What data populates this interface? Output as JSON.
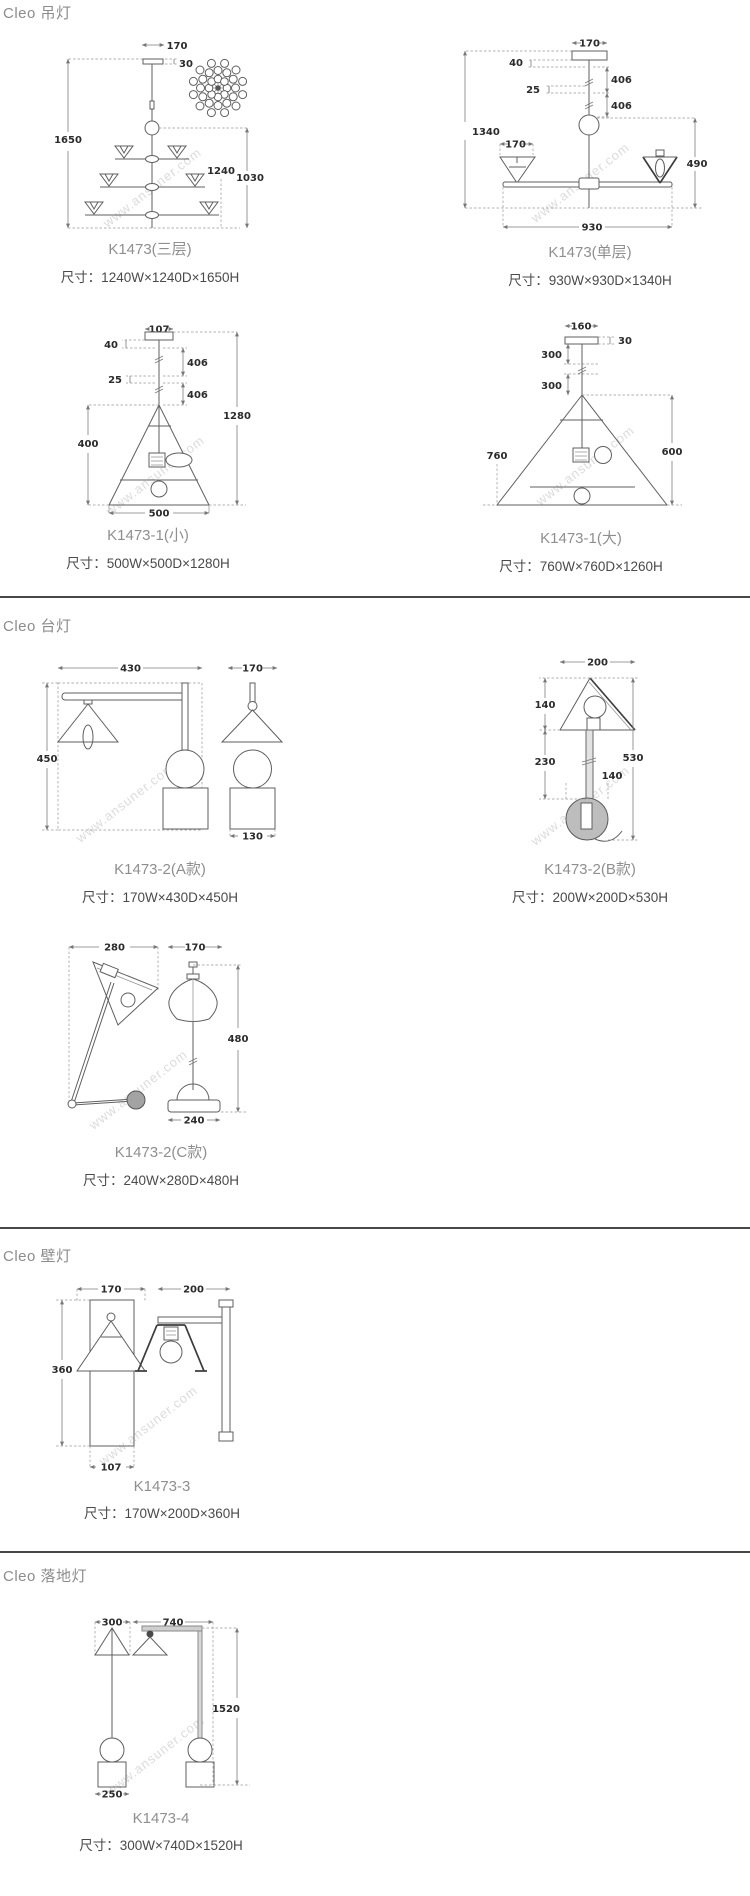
{
  "page": {
    "watermark": "www.ansuner.com"
  },
  "sections": [
    {
      "header": "Cleo 吊灯",
      "products": [
        {
          "name": "K1473(三层)",
          "spec": "尺寸：1240W×1240D×1650H",
          "dims": {
            "top_w": "170",
            "canopy_h": "30",
            "total_h": "1650",
            "width": "1240",
            "body_h": "1030"
          }
        },
        {
          "name": "K1473(单层)",
          "spec": "尺寸：930W×930D×1340H",
          "dims": {
            "top_w": "170",
            "seg_40": "40",
            "rod_a": "406",
            "seg_25": "25",
            "rod_b": "406",
            "total_h": "1340",
            "shade_w": "170",
            "drop_h": "490",
            "width": "930"
          }
        },
        {
          "name": "K1473-1(小)",
          "spec": "尺寸：500W×500D×1280H",
          "dims": {
            "top_w": "107",
            "seg_40": "40",
            "rod_a": "406",
            "seg_25": "25",
            "rod_b": "406",
            "total_h": "1280",
            "shade_h": "400",
            "width": "500"
          }
        },
        {
          "name": "K1473-1(大)",
          "spec": "尺寸：760W×760D×1260H",
          "dims": {
            "top_w": "160",
            "canopy_h": "30",
            "rod_a": "300",
            "rod_b": "300",
            "width": "760",
            "shade_h": "600"
          }
        }
      ]
    },
    {
      "header": "Cleo 台灯",
      "products": [
        {
          "name": "K1473-2(A款)",
          "spec": "尺寸：170W×430D×450H",
          "dims": {
            "depth": "430",
            "shade_w": "170",
            "height": "450",
            "base_w": "130"
          }
        },
        {
          "name": "K1473-2(B款)",
          "spec": "尺寸：200W×200D×530H",
          "dims": {
            "shade_w": "200",
            "shade_h": "140",
            "rod_h": "230",
            "total_h": "530",
            "ball_d": "140"
          }
        },
        {
          "name": "K1473-2(C款)",
          "spec": "尺寸：240W×280D×480H",
          "dims": {
            "depth": "280",
            "shade_w": "170",
            "height": "480",
            "base_w": "240"
          }
        }
      ]
    },
    {
      "header": "Cleo 壁灯",
      "products": [
        {
          "name": "K1473-3",
          "spec": "尺寸：170W×200D×360H",
          "dims": {
            "front_w": "170",
            "side_d": "200",
            "height": "360",
            "plate_w": "107"
          }
        }
      ]
    },
    {
      "header": "Cleo 落地灯",
      "products": [
        {
          "name": "K1473-4",
          "spec": "尺寸：300W×740D×1520H",
          "dims": {
            "shade_w": "300",
            "depth": "740",
            "height": "1520",
            "base_w": "250"
          }
        }
      ]
    }
  ]
}
